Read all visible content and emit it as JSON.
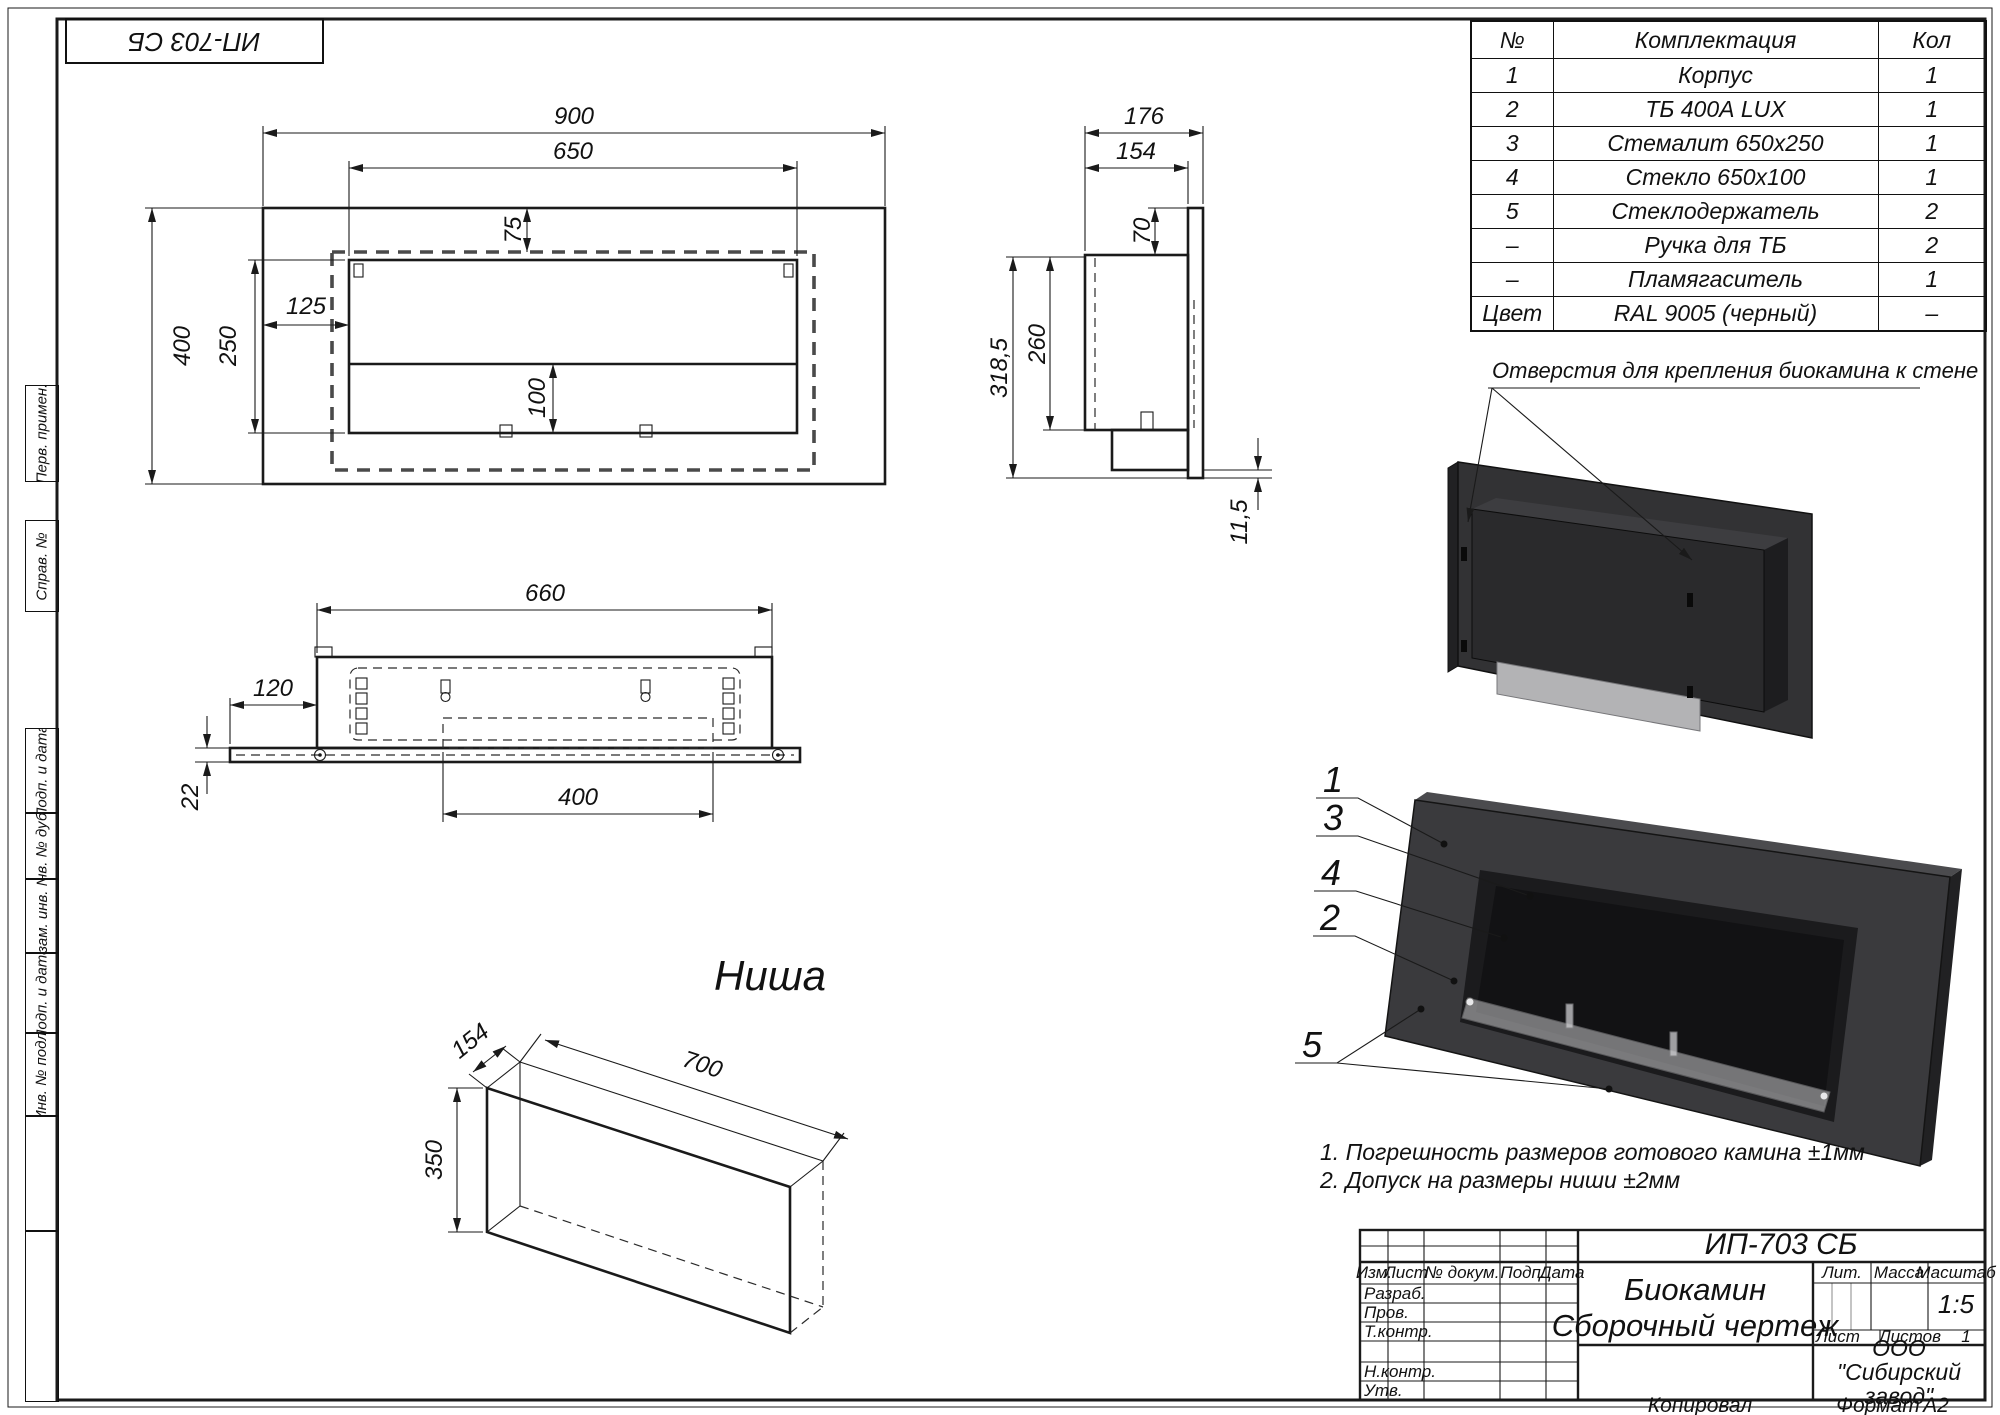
{
  "stamp_doc": "ИП-703 СБ",
  "side_labels": [
    "Перв. примен.",
    "Справ. №",
    "Подп. и дата",
    "Инв. № дубл.",
    "Взам. инв. №",
    "Подп. и дата",
    "Инв. № подл."
  ],
  "parts_table": {
    "headers": {
      "no": "№",
      "name": "Комплектация",
      "qty": "Кол"
    },
    "rows": [
      {
        "no": "1",
        "name": "Корпус",
        "qty": "1"
      },
      {
        "no": "2",
        "name": "ТБ 400А LUX",
        "qty": "1"
      },
      {
        "no": "3",
        "name": "Стемалит 650х250",
        "qty": "1"
      },
      {
        "no": "4",
        "name": "Стекло 650х100",
        "qty": "1"
      },
      {
        "no": "5",
        "name": "Стеклодержатель",
        "qty": "2"
      },
      {
        "no": "–",
        "name": "Ручка для ТБ",
        "qty": "2"
      },
      {
        "no": "–",
        "name": "Пламягаситель",
        "qty": "1"
      },
      {
        "no": "Цвет",
        "name": "RAL 9005 (черный)",
        "qty": "–"
      }
    ]
  },
  "views": {
    "front": {
      "dims": {
        "width": "900",
        "opening_width": "650",
        "top_offset": "75",
        "left_offset": "125",
        "opening_height": "250",
        "height": "400",
        "glass_height": "100"
      }
    },
    "side": {
      "dims": {
        "depth": "176",
        "inner_depth": "154",
        "flange": "70",
        "body_height": "260",
        "total_height": "318,5",
        "bottom_gap": "11,5"
      }
    },
    "bottom": {
      "dims": {
        "width": "660",
        "side_ext": "120",
        "slot_span": "400",
        "plate": "22"
      }
    },
    "niche": {
      "label": "Ниша",
      "dims": {
        "depth": "154",
        "width": "700",
        "height": "350"
      }
    }
  },
  "annotation_mount_holes": "Отверстия для крепления биокамина к стене",
  "callouts": {
    "c1": "1",
    "c3": "3",
    "c4": "4",
    "c2": "2",
    "c5": "5"
  },
  "notes": [
    "1. Погрешность размеров готового камина ±1мм",
    "2. Допуск на размеры ниши ±2мм"
  ],
  "title_block": {
    "doc_number": "ИП-703 СБ",
    "product": "Биокамин",
    "doc_type": "Сборочный чертеж",
    "izm": "Изм.",
    "list": "Лист",
    "dokum": "№ докум.",
    "podp": "Подп.",
    "date": "Дата",
    "razrab": "Разраб.",
    "prov": "Пров.",
    "tkontr": "Т.контр.",
    "nkontr": "Н.контр.",
    "utv": "Утв.",
    "lit": "Лит.",
    "massa": "Масса",
    "scale_label": "Масштаб",
    "scale": "1:5",
    "sheet_label": "Лист",
    "sheets_label": "Листов",
    "sheets": "1",
    "company": "ООО \"Сибирский завод\"",
    "copied": "Копировал",
    "format_label": "Формат",
    "format": "А2"
  },
  "colors": {
    "line": "#1a1a1a",
    "wall_panel": "#323234",
    "panel_edge": "#212123",
    "body": "#2a2a2c",
    "body_top": "#3d3d40",
    "body_side": "#1d1d1f",
    "bracket": "#b3b3b5",
    "panel_front": "#3a3a3d",
    "panel_top": "#4b4b4e",
    "recess": "#1b1b1d",
    "back_wall": "#121214",
    "glass": "#d8d8da"
  }
}
